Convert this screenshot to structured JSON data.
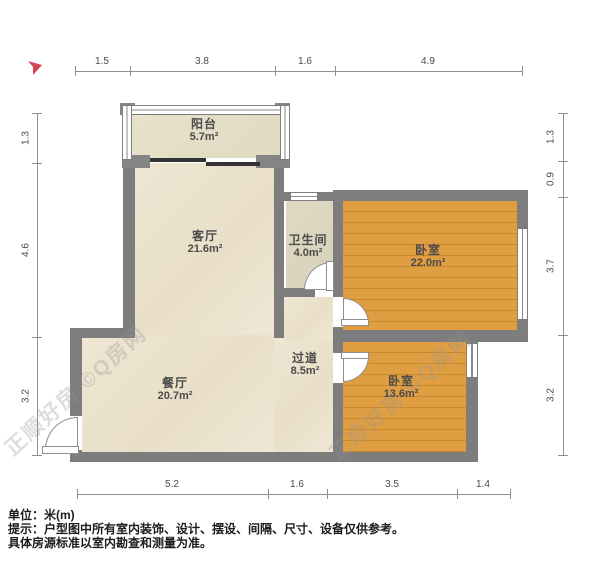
{
  "title": "户型图",
  "north_indicator": "north-arrow",
  "rooms": [
    {
      "name": "阳台",
      "area": "5.7m²"
    },
    {
      "name": "客厅",
      "area": "21.6m²"
    },
    {
      "name": "卫生间",
      "area": "4.0m²"
    },
    {
      "name": "卧室",
      "area": "22.0m²"
    },
    {
      "name": "过道",
      "area": "8.5m²"
    },
    {
      "name": "餐厅",
      "area": "20.7m²"
    },
    {
      "name": "卧室",
      "area": "13.6m²"
    }
  ],
  "dimensions": {
    "top": [
      "1.5",
      "3.8",
      "1.6",
      "4.9"
    ],
    "bottom": [
      "5.2",
      "1.6",
      "3.5",
      "1.4"
    ],
    "left": [
      "1.3",
      "4.6",
      "3.2"
    ],
    "right": [
      "1.3",
      "0.9",
      "3.7",
      "3.2"
    ]
  },
  "watermark": {
    "text": "正顺好房 ©Q房网"
  },
  "footer": {
    "unit": "单位：米(m)",
    "tip": "提示：户型图中所有室内装饰、设计、摆设、间隔、尺寸、设备仅供参考。",
    "tip2": "具体房源标准以室内勘查和测量为准。"
  },
  "colors": {
    "wall": "#7d7d7d",
    "floor": "#ece3cf",
    "wood": "#dd9a3d",
    "bath": "#dcd6bf",
    "north_arrow": "#d64550",
    "dim_line": "#8f8f8f"
  }
}
